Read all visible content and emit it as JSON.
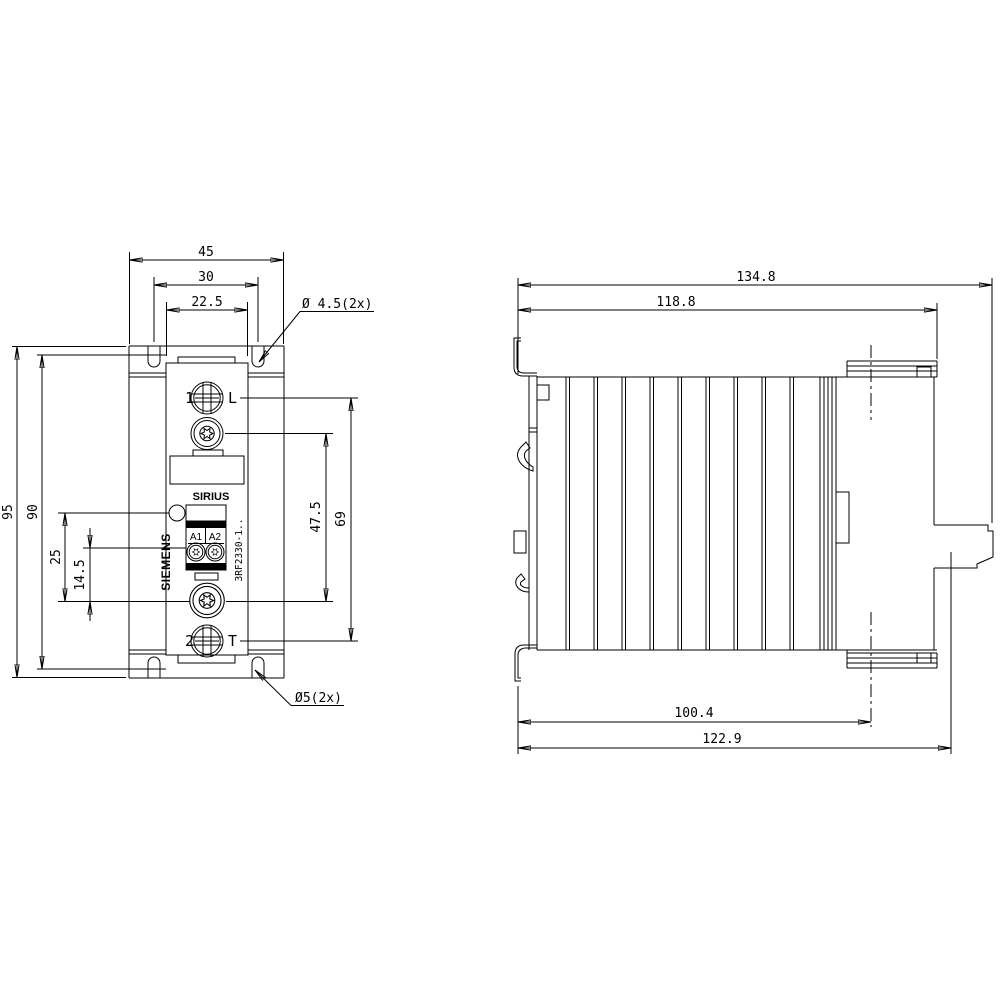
{
  "front_view": {
    "labels": {
      "terminal_1": "1",
      "terminal_1_letter": "L",
      "terminal_2": "2",
      "terminal_2_letter": "T",
      "product_line": "SIRIUS",
      "brand": "SIEMENS",
      "coil_a1": "A1",
      "coil_a2": "A2",
      "type_code": "3RF2330-1.."
    },
    "dimensions": {
      "width_total": "45",
      "width_slot_centers": "30",
      "width_housing": "22.5",
      "top_holes": "Ø 4.5(2x)",
      "height_total": "95",
      "height_inner": "90",
      "led_to_torx": "25",
      "coil_to_torx": "14.5",
      "torx_spacing": "47.5",
      "terminal_spacing": "69",
      "bottom_holes": "Ø5(2x)"
    }
  },
  "side_view": {
    "dimensions": {
      "depth_total": "134.8",
      "depth_body": "118.8",
      "depth_to_hole_center": "100.4",
      "depth_with_rail": "122.9"
    }
  }
}
